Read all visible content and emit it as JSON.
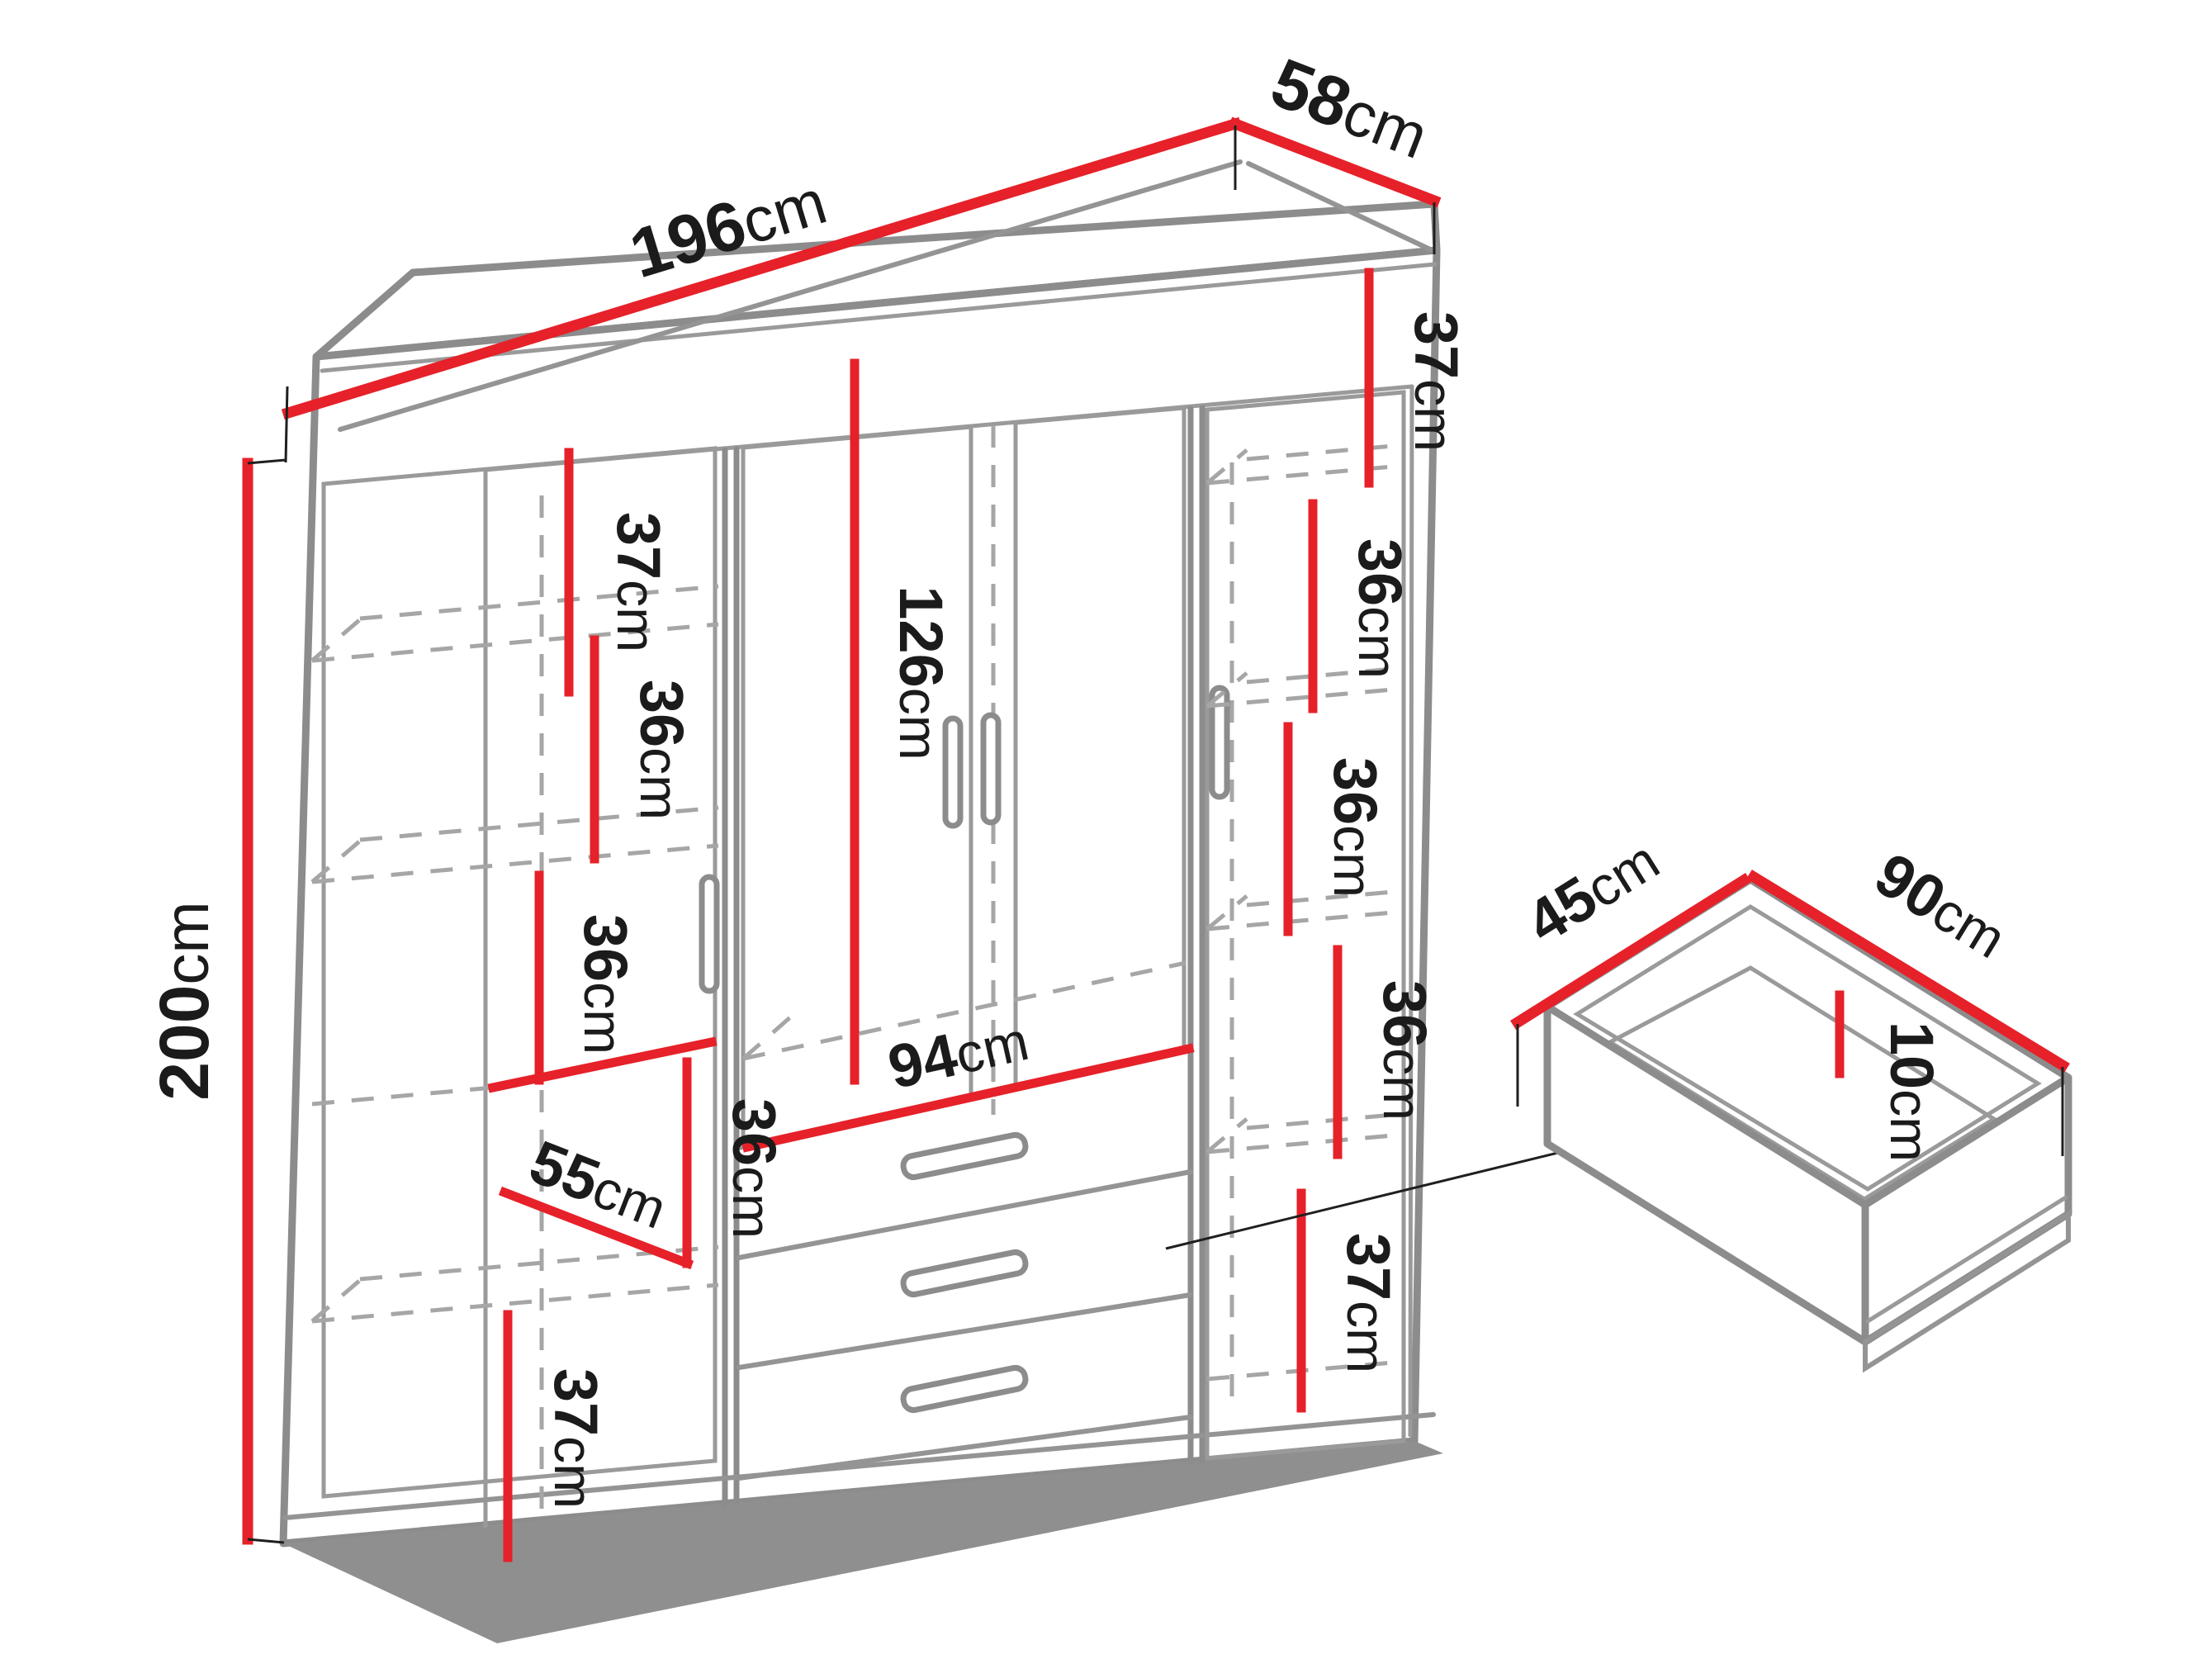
{
  "colors": {
    "dimension_red": "#e62129",
    "outline_gray": "#8c8c8c",
    "dashed_gray": "#a6a6a6",
    "shadow_gray": "#8f8f8f",
    "text_black": "#1b1b1b",
    "background": "#ffffff"
  },
  "wardrobe": {
    "overall": {
      "width": {
        "num": "196",
        "unit": "cm"
      },
      "depth": {
        "num": "58",
        "unit": "cm"
      },
      "height": {
        "num": "200",
        "unit": "cm"
      }
    },
    "left_column": [
      {
        "num": "37",
        "unit": "cm"
      },
      {
        "num": "36",
        "unit": "cm"
      },
      {
        "num": "36",
        "unit": "cm"
      },
      {
        "num": "36",
        "unit": "cm"
      },
      {
        "num": "55",
        "unit": "cm"
      },
      {
        "num": "37",
        "unit": "cm"
      }
    ],
    "center": [
      {
        "num": "126",
        "unit": "cm"
      },
      {
        "num": "94",
        "unit": "cm"
      }
    ],
    "right_column": [
      {
        "num": "37",
        "unit": "cm"
      },
      {
        "num": "36",
        "unit": "cm"
      },
      {
        "num": "36",
        "unit": "cm"
      },
      {
        "num": "36",
        "unit": "cm"
      },
      {
        "num": "37",
        "unit": "cm"
      }
    ]
  },
  "drawer_detail": {
    "depth": {
      "num": "45",
      "unit": "cm"
    },
    "width": {
      "num": "90",
      "unit": "cm"
    },
    "height": {
      "num": "10",
      "unit": "cm"
    }
  }
}
